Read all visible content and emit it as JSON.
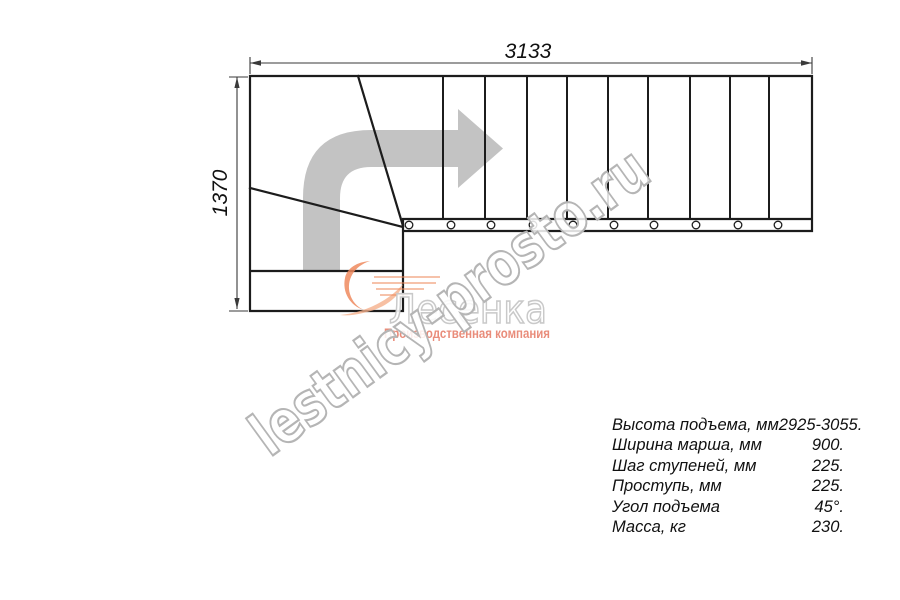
{
  "colors": {
    "line": "#1c1c1c",
    "dim": "#3a3a3a",
    "text": "#111111",
    "arrow-gray": "#c3c3c3",
    "watermark-stroke": "#b5b5b5",
    "logo-outline": "#c9c9c9",
    "logo-orange": "#ef8a5e",
    "logo-orange-light": "#f5b08c",
    "logo-tagline": "#e4705a"
  },
  "dimensions": {
    "total_length_mm": "3133",
    "total_width_mm": "1370"
  },
  "watermark": {
    "text": "lestnicy-prosto.ru"
  },
  "logo": {
    "name": "Лесенка",
    "tagline": "Производственная компания"
  },
  "specs": {
    "rows": [
      {
        "label": "Высота подъема, мм",
        "value": "2925-3055."
      },
      {
        "label": "Ширина марша, мм",
        "value": "900."
      },
      {
        "label": "Шаг ступеней, мм",
        "value": "225."
      },
      {
        "label": "Проступь, мм",
        "value": "225."
      },
      {
        "label": "Угол подъема",
        "value": "45°."
      },
      {
        "label": "Масса, кг",
        "value": "230."
      }
    ]
  }
}
